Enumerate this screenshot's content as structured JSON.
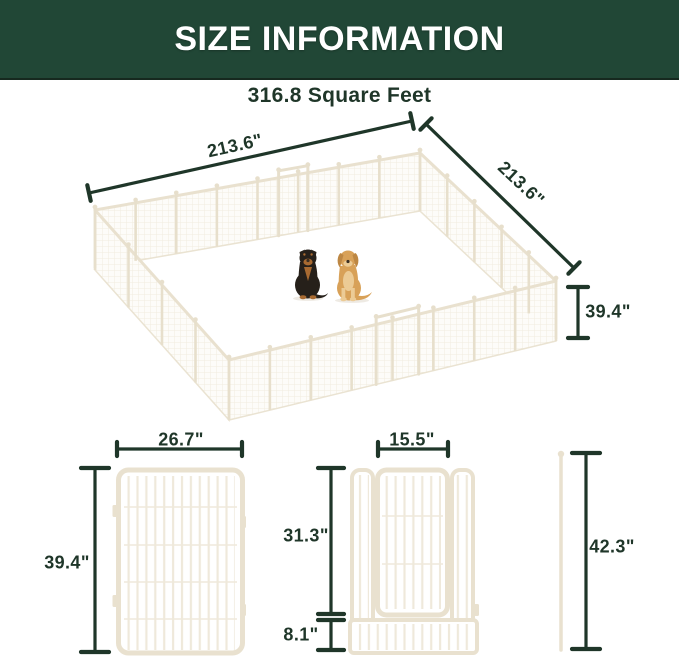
{
  "header": {
    "title": "SIZE INFORMATION"
  },
  "area_label": "316.8 Square Feet",
  "pen_diagram": {
    "side_a": "213.6\"",
    "side_b": "213.6\"",
    "height": "39.4\"",
    "dogs": [
      "rottweiler",
      "golden-retriever"
    ]
  },
  "panel_diagram": {
    "width": "26.7\"",
    "height": "39.4\""
  },
  "door_panel_diagram": {
    "door_width": "15.5\"",
    "door_height": "31.3\"",
    "bottom_height": "8.1\""
  },
  "stake_diagram": {
    "height": "42.3\""
  },
  "colors": {
    "header-bg": "#214736",
    "header-edge": "#16291f",
    "header-text": "#ffffff",
    "ink": "#1f3629",
    "panel-frame": "#e9e1cf",
    "panel-bar": "#efe9db",
    "mesh-line": "#f1ecdf",
    "mesh-bg": "#fdfcf9",
    "post": "#e7dfcc",
    "rott-dark": "#26201a",
    "rott-tan": "#a86a31",
    "golden-coat": "#d8a158",
    "golden-light": "#eccb95",
    "golden-dark": "#bd8743",
    "nose": "#3a2e22"
  }
}
